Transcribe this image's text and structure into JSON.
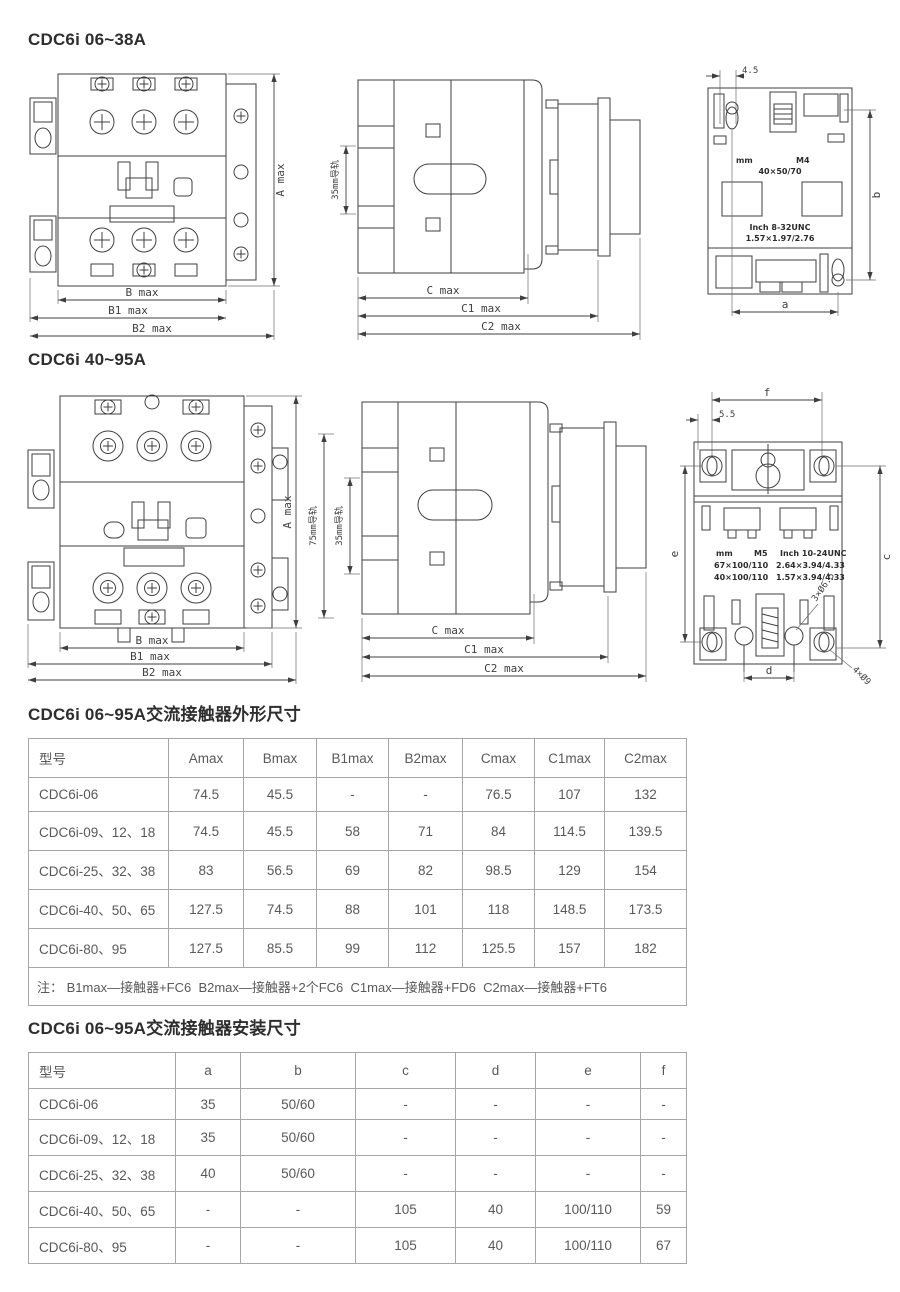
{
  "sections": {
    "s1": "CDC6i 06~38A",
    "s2": "CDC6i 40~95A",
    "s3": "CDC6i 06~95A交流接触器外形尺寸",
    "s4": "CDC6i 06~95A交流接触器安装尺寸"
  },
  "drawings": {
    "front1": {
      "dim_a": "A max",
      "dim_b": "B max",
      "dim_b1": "B1 max",
      "dim_b2": "B2 max"
    },
    "side1": {
      "rail": "35mm导轨",
      "dim_c": "C max",
      "dim_c1": "C1 max",
      "dim_c2": "C2 max"
    },
    "back1": {
      "dim_offset": "4.5",
      "dim_b": "b",
      "dim_a": "a",
      "unit_mm": "mm",
      "thread_mm": "M4",
      "mount_mm": "40×50/70",
      "unit_inch": "Inch 8-32UNC",
      "mount_inch": "1.57×1.97/2.76"
    },
    "front2": {
      "dim_a": "A max",
      "dim_b": "B max",
      "dim_b1": "B1 max",
      "dim_b2": "B2 max"
    },
    "side2": {
      "rail_75": "75mm导轨",
      "rail_35": "35mm导轨",
      "dim_c": "C max",
      "dim_c1": "C1 max",
      "dim_c2": "C2 max"
    },
    "back2": {
      "dim_offset": "5.5",
      "dim_f": "f",
      "dim_e": "e",
      "dim_c": "c",
      "dim_d": "d",
      "holes_small": "3×Ø6.5",
      "holes_large": "4×Ø9",
      "unit_mm": "mm",
      "thread_mm": "M5",
      "unit_inch": "Inch 10-24UNC",
      "mm_row1": "67×100/110",
      "inch_row1": "2.64×3.94/4.33",
      "mm_row2": "40×100/110",
      "inch_row2": "1.57×3.94/4.33"
    }
  },
  "table1": {
    "headers": [
      "型号",
      "Amax",
      "Bmax",
      "B1max",
      "B2max",
      "Cmax",
      "C1max",
      "C2max"
    ],
    "rows": [
      [
        "CDC6i-06",
        "74.5",
        "45.5",
        "-",
        "-",
        "76.5",
        "107",
        "132"
      ],
      [
        "CDC6i-09、12、18",
        "74.5",
        "45.5",
        "58",
        "71",
        "84",
        "114.5",
        "139.5"
      ],
      [
        "CDC6i-25、32、38",
        "83",
        "56.5",
        "69",
        "82",
        "98.5",
        "129",
        "154"
      ],
      [
        "CDC6i-40、50、65",
        "127.5",
        "74.5",
        "88",
        "101",
        "118",
        "148.5",
        "173.5"
      ],
      [
        "CDC6i-80、95",
        "127.5",
        "85.5",
        "99",
        "112",
        "125.5",
        "157",
        "182"
      ]
    ],
    "note": "注： B1max—接触器+FC6  B2max—接触器+2个FC6  C1max—接触器+FD6  C2max—接触器+FT6"
  },
  "table2": {
    "headers": [
      "型号",
      "a",
      "b",
      "c",
      "d",
      "e",
      "f"
    ],
    "rows": [
      [
        "CDC6i-06",
        "35",
        "50/60",
        "-",
        "-",
        "-",
        "-"
      ],
      [
        "CDC6i-09、12、18",
        "35",
        "50/60",
        "-",
        "-",
        "-",
        "-"
      ],
      [
        "CDC6i-25、32、38",
        "40",
        "50/60",
        "-",
        "-",
        "-",
        "-"
      ],
      [
        "CDC6i-40、50、65",
        "-",
        "-",
        "105",
        "40",
        "100/110",
        "59"
      ],
      [
        "CDC6i-80、95",
        "-",
        "-",
        "105",
        "40",
        "100/110",
        "67"
      ]
    ]
  }
}
